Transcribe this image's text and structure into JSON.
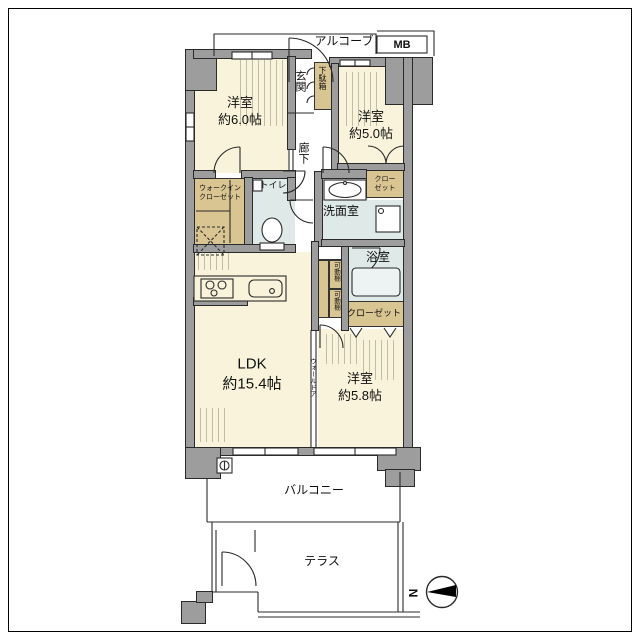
{
  "plan": {
    "alcove": "アルコーブ",
    "mb": "MB",
    "entrance": "玄関",
    "shoe_cabinet": "下駄箱",
    "room1": {
      "name": "洋室",
      "size": "約6.0帖"
    },
    "room2": {
      "name": "洋室",
      "size": "約5.0帖"
    },
    "hallway": "廊下",
    "toilet": "トイレ",
    "wic": {
      "line1": "ウォークイン",
      "line2": "クローゼット"
    },
    "closet_room2": {
      "line1": "クロー",
      "line2": "ゼット"
    },
    "washroom": "洗面室",
    "bathroom": "浴室",
    "shelf_upper": "可動棚",
    "shelf_lower": "可動棚",
    "closet_room3": "クローゼット",
    "ldk": {
      "name": "LDK",
      "size": "約15.4帖"
    },
    "wall_door": "ウォールドア",
    "room3": {
      "name": "洋室",
      "size": "約5.8帖"
    },
    "balcony": "バルコニー",
    "terrace": "テラス",
    "north": "N"
  },
  "colors": {
    "room_floor": "#F8F3DA",
    "wet_area": "#DFE9E8",
    "closet": "#D9C591",
    "wall": "#9D9D9D"
  }
}
